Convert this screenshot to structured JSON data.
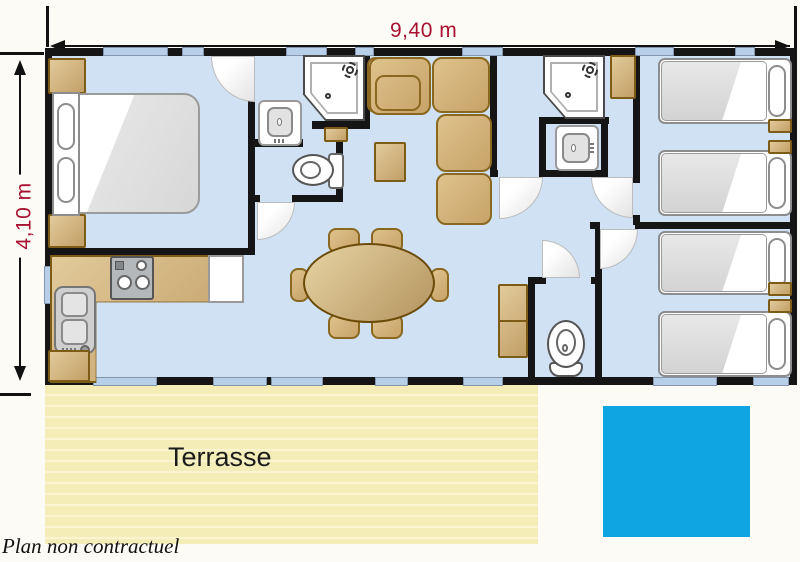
{
  "floorplan": {
    "width_dimension": "9,40 m",
    "depth_dimension": "4,10 m",
    "terrace_label": "Terrasse",
    "disclaimer": "Plan non contractuel"
  },
  "colors": {
    "floor": "#cfe1f3",
    "wall": "#151515",
    "window_glass": "#b7cfe8",
    "furniture_tan": "#d2b284",
    "furniture_border": "#7c5c17",
    "terrace": "#f5edb7",
    "pool_blue": "#0fa5e2",
    "dimension_text": "#a8112f"
  }
}
